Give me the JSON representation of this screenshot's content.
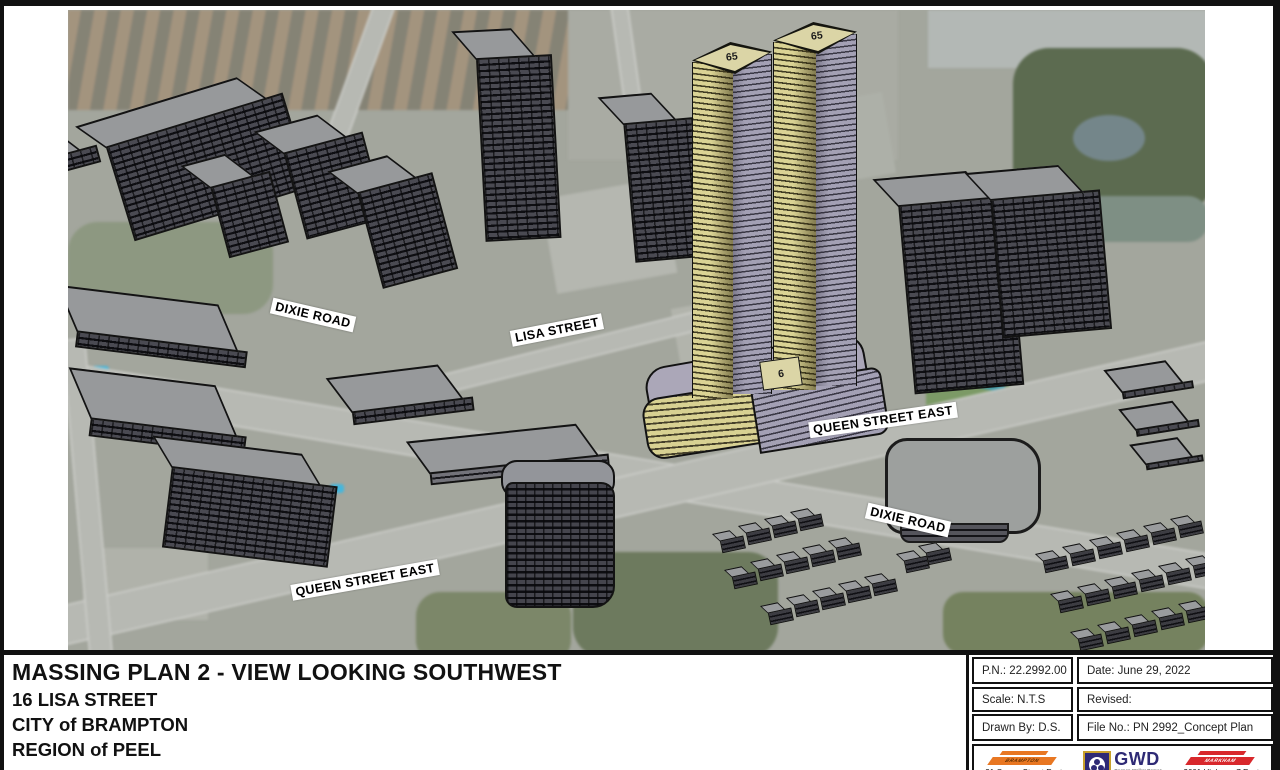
{
  "drawing": {
    "street_labels": [
      {
        "text": "DIXIE ROAD"
      },
      {
        "text": "LISA STREET"
      },
      {
        "text": "QUEEN STREET EAST"
      },
      {
        "text": "DIXIE ROAD"
      },
      {
        "text": "QUEEN STREET EAST"
      }
    ],
    "building_labels": {
      "west_tower_storeys": "65",
      "east_tower_storeys": "65",
      "podium_storeys": "6"
    }
  },
  "title_block": {
    "title": "MASSING PLAN 2 - VIEW LOOKING SOUTHWEST",
    "address": "16 LISA STREET",
    "municipality": "CITY of BRAMPTON",
    "region": "REGION of PEEL"
  },
  "info_table": {
    "project_number": "P.N.: 22.2992.00",
    "date": "Date: June 29, 2022",
    "scale": "Scale: N.T.S",
    "revised": "Revised:",
    "drawn_by": "Drawn By: D.S.",
    "file_no": "File No.: PN 2992_Concept Plan"
  },
  "logos": {
    "brampton": {
      "name": "BRAMPTON",
      "address": "21 Queen Street East"
    },
    "gwd": {
      "initials": "GWD",
      "firm": "Gagnon Walker Domes"
    },
    "markham": {
      "name": "MARKHAM",
      "address": "3601 Highway 7 East"
    }
  },
  "colors": {
    "proposed_yellow": "#d8d192",
    "proposed_lavender": "#a3a0b4",
    "context_massing": "#3a3a40",
    "brampton_orange": "#e87722",
    "markham_red": "#d8282c",
    "gwd_purple": "#2e2a75",
    "gwd_gold": "#c8a02c"
  }
}
